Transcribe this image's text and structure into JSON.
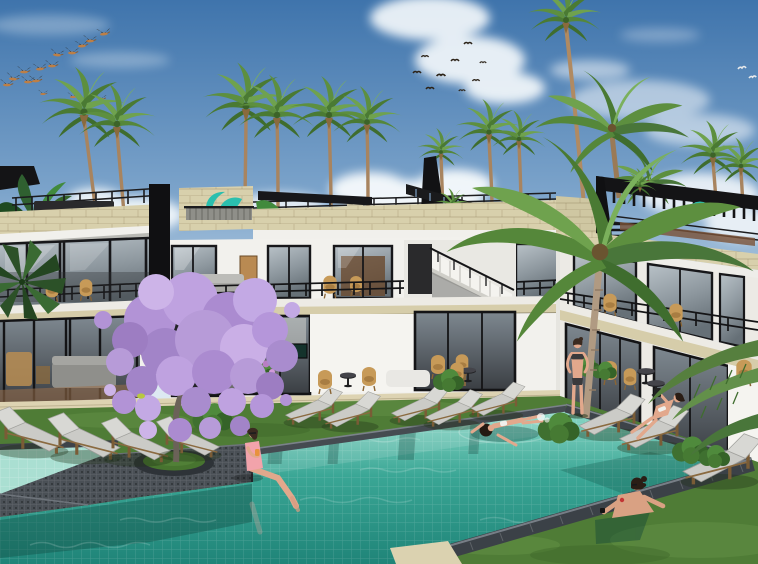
{
  "scene": {
    "kind": "architectural-3d-render",
    "description": "Daytime 3D visualization of a modern two-storey white tropical resort with rooftop palm garden, a blooming jacaranda tree and a turquoise mosaic swimming pool with bathers",
    "sky": {
      "condition": "blue with scattered cumulus clouds",
      "bird_flock_left_count": 15,
      "bird_flock_center_count": 9,
      "bird_pair_right_count": 2
    },
    "buildings": {
      "storeys": 2,
      "style": "modern minimalist, white walls, black-framed floor-to-ceiling glazing, travertine parapet bands",
      "features": [
        "rooftop palm garden",
        "black pergolas",
        "teal brand logo on rooftop wall",
        "teal rooftop umbrella",
        "external white staircase",
        "balconies with black railings and rattan furniture"
      ]
    },
    "pool": {
      "water": "turquoise mosaic tile",
      "coping": "dark grey mosaic",
      "deck_island": "dark stone peninsula with circular grass planter holding jacaranda tree",
      "sections": [
        "shallow left lap section",
        "main swimming pool"
      ]
    },
    "people": [
      {
        "id": "person-sitting-poolside",
        "pose": "sitting on pool edge with legs in water, pink swimsuit, holding orange drink"
      },
      {
        "id": "person-floating",
        "pose": "floating on back in pool, white bikini"
      },
      {
        "id": "person-leaning-pool-edge",
        "pose": "in water leaning on near coping, dark hair bun, black wristband"
      },
      {
        "id": "person-standing-lawn",
        "pose": "standing on lawn in dark bikini, hands on hips"
      },
      {
        "id": "person-on-lounger",
        "pose": "reclining on sun lounger holding phone, white bikini"
      }
    ],
    "furniture": {
      "sun_loungers_poolside": 12,
      "sun_loungers_rooftop": 2,
      "round_side_tables": 4,
      "rattan_chairs": 4,
      "white_daybed": 1
    },
    "vegetation": {
      "fan_palms": 11,
      "coconut_palms": 3,
      "jacaranda_tree": 1,
      "banana_plants": 2,
      "shrubs": 8,
      "tiny_yellow_bird_on_branch": 1
    }
  },
  "colors": {
    "sky_top": "#3f74ac",
    "sky_mid": "#7ba3ca",
    "sky_horizon": "#dde9f2",
    "cloud": "#f7fafc",
    "water_far": "#93dccb",
    "water_mid": "#3aa695",
    "water_near": "#1f8478",
    "shallow_pool": "#aadfd2",
    "coping": "#3d4349",
    "deck": "#4a5056",
    "grass": "#4f7c36",
    "stone": "#d8d0ac",
    "white_wall": "#f2f1ed",
    "frame_black": "#17171a",
    "glass": "#9aa5ad",
    "wood": "#8a6a40",
    "cushion": "#cbcbc7",
    "blossom": "#b79bd8",
    "palm_green": "#5d8f3f",
    "brand_teal": "#2bbfae",
    "skin": "#e2a88c",
    "swimsuit_pink": "#f2a3ab",
    "drink_orange": "#e8923e"
  }
}
